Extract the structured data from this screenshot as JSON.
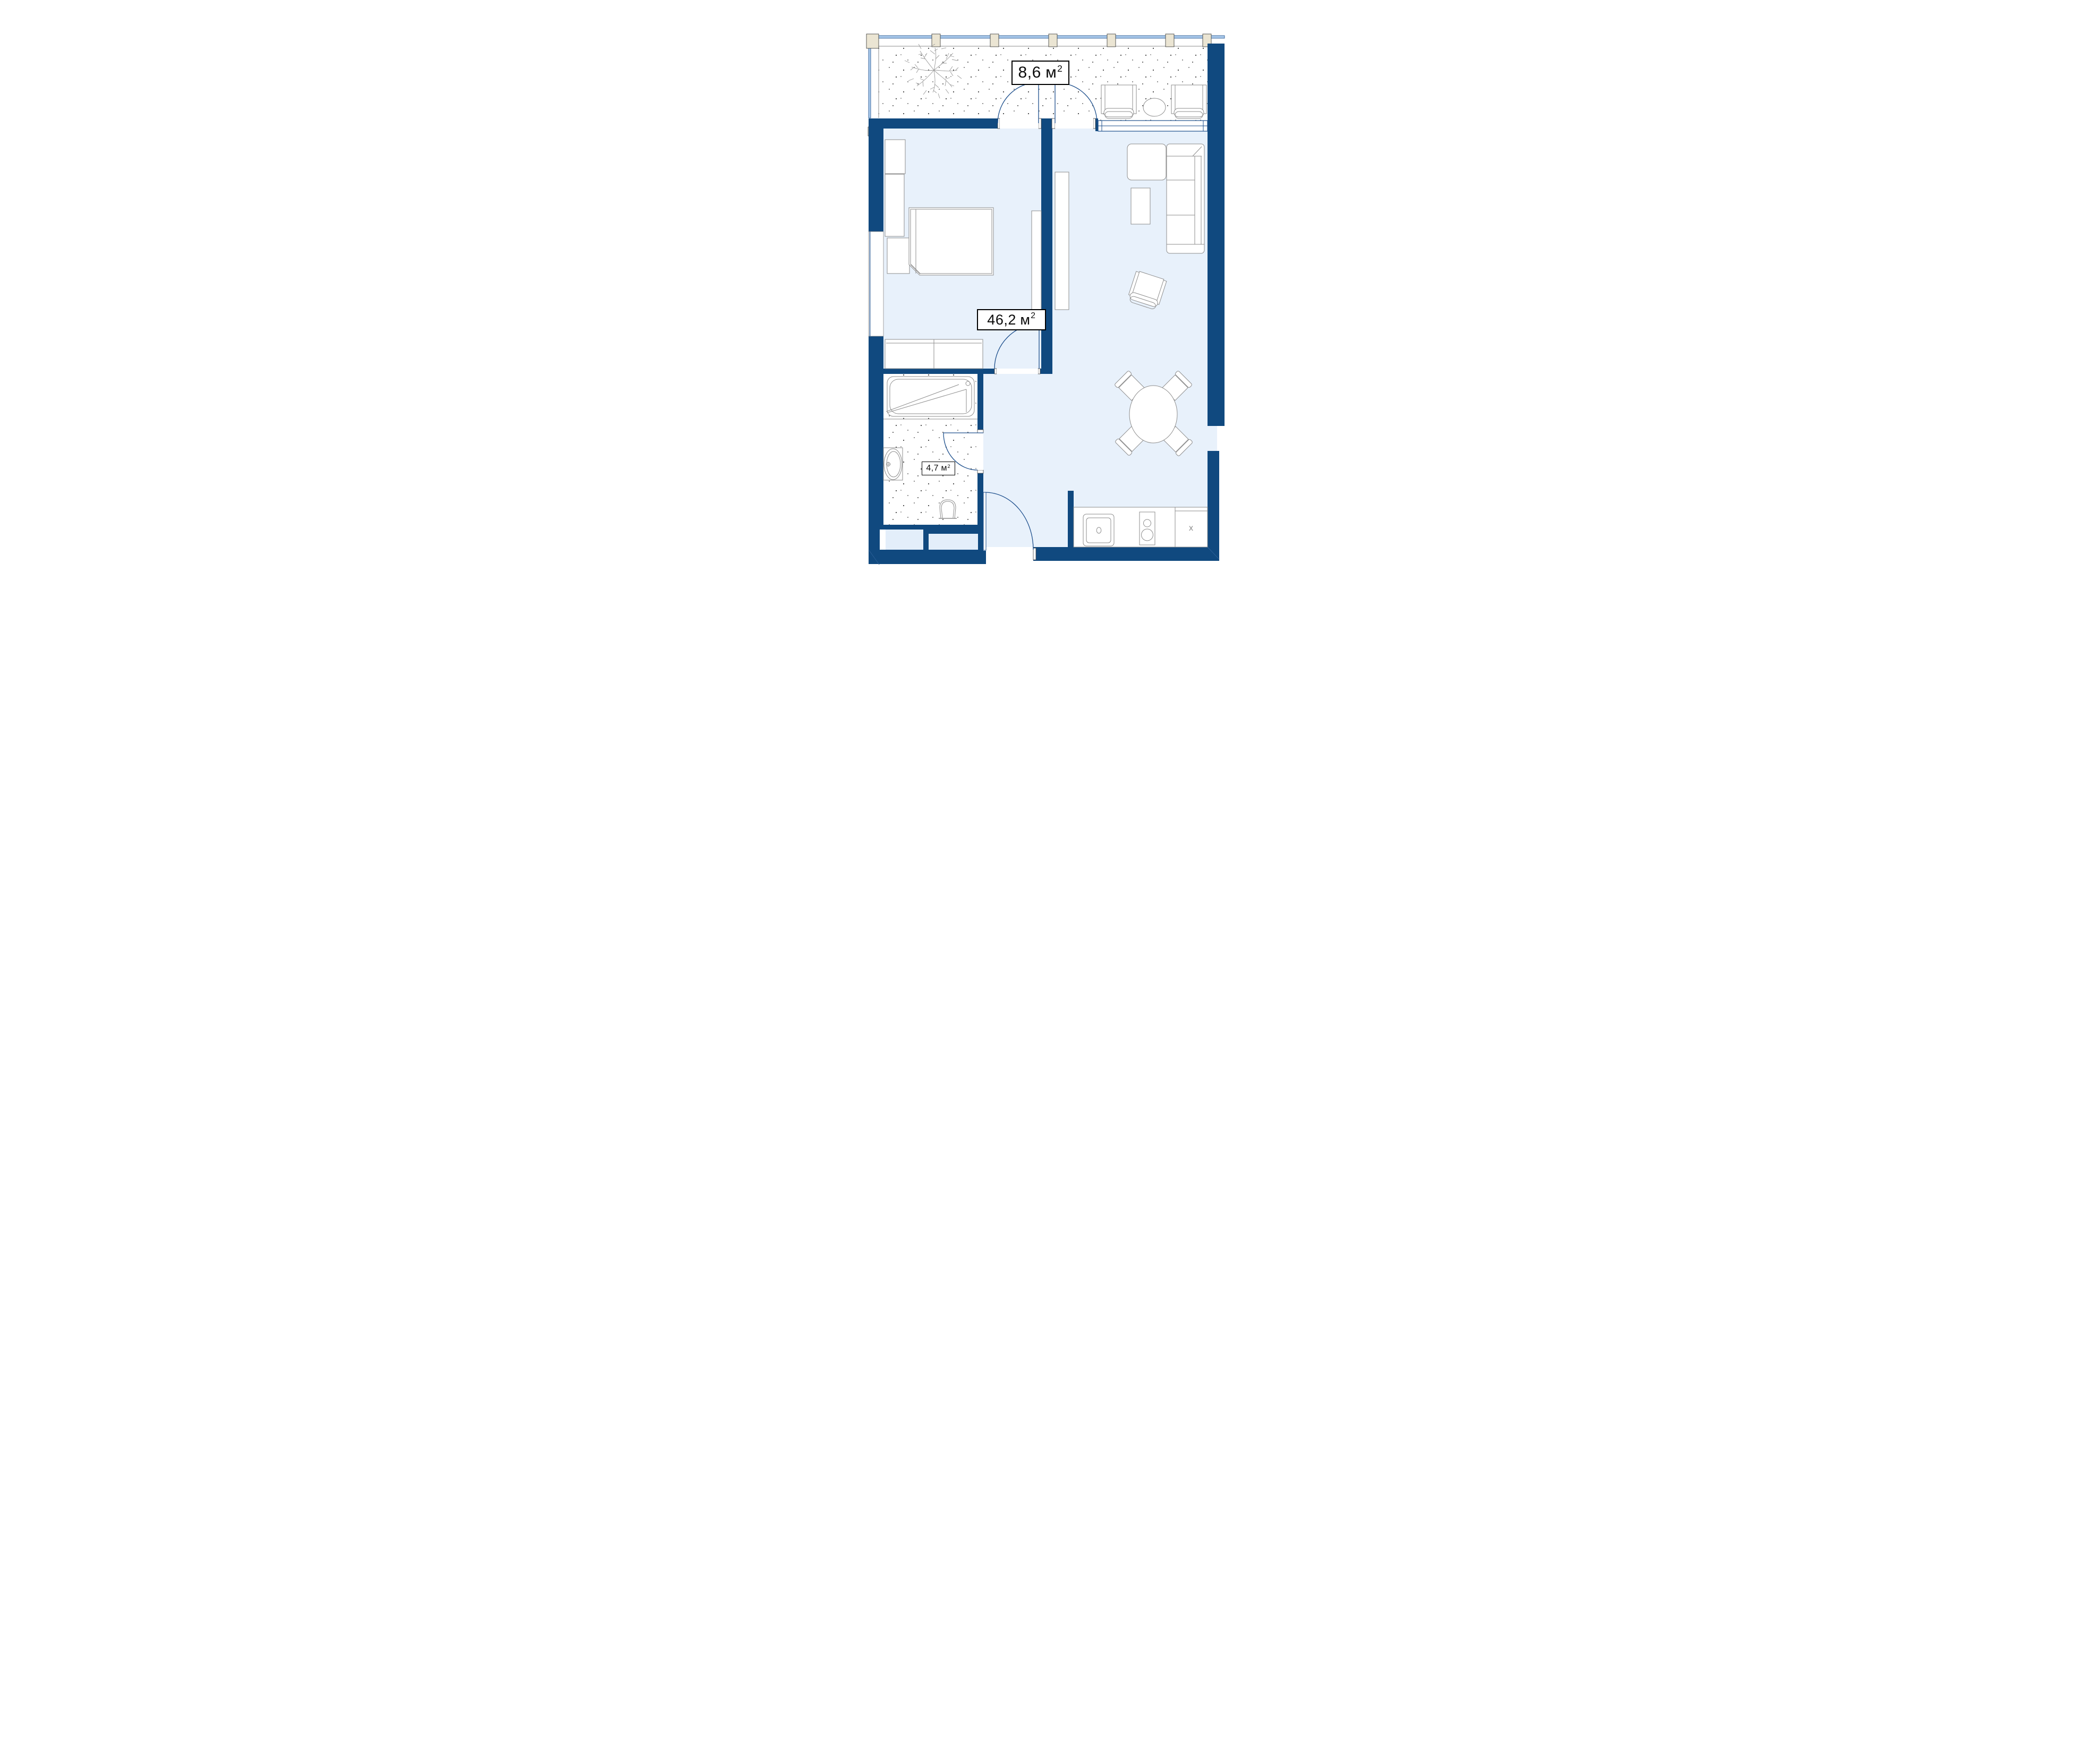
{
  "plan": {
    "type": "apartment-floorplan",
    "labels": {
      "balcony": {
        "value": "8,6",
        "unit": "м",
        "exp": "2"
      },
      "main": {
        "value": "46,2",
        "unit": "м",
        "exp": "2"
      },
      "bathroom": {
        "value": "4,7",
        "unit": "м",
        "exp": "2"
      }
    },
    "markers": {
      "kitchen_unit": "x"
    },
    "colors": {
      "wall": "#10497f",
      "floor": "#e8f1fb",
      "niche_floor": "#e3eefa",
      "glazing": "#abcaeb",
      "mullion": "#ebe5d3",
      "line_blue": "#1d4f8c",
      "line_gray": "#8d8d8d",
      "stipple_dot": "#3f3f3f",
      "label_border": "#000000",
      "label_bg": "#ffffff"
    }
  }
}
